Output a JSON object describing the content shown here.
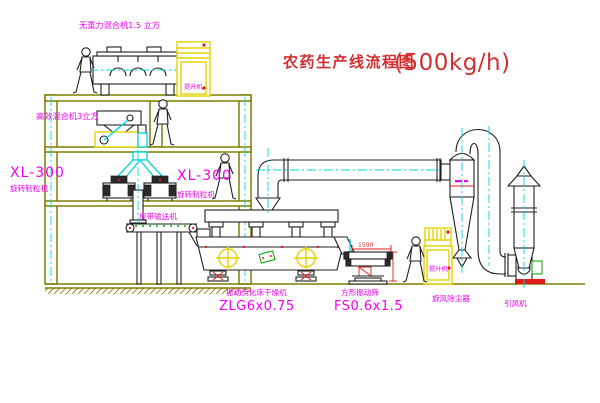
{
  "title": {
    "text": "农药生产线流程图",
    "capacity": "(500kg/h)"
  },
  "colors": {
    "label_magenta": "#f000f0",
    "title_red": "#d23030",
    "structure_olive": "#7f7f00",
    "machine_black": "#1f1f1f",
    "centerline_cyan": "#00d4da",
    "equipment_yellow": "#e3d400",
    "accent_red": "#e01818",
    "accent_green": "#00b400",
    "background": "#ffffff"
  },
  "labels": {
    "gravity_free_mixer": "无重力混合机1.5 立方",
    "high_efficiency_mixer": "高效混合机3立方",
    "granulator_wall": {
      "model": "XL-300",
      "name": "旋转制粒机"
    },
    "granulator": {
      "model": "XL-300",
      "name": "旋转制粒机"
    },
    "belt_conveyor": "皮带输送机",
    "dryer": {
      "name": "振动流化床干燥机",
      "model": "ZLG6x0.75"
    },
    "sieve": {
      "name": "方形振动筛",
      "model": "FS0.6x1.5"
    },
    "cyclone": "旋风除尘器",
    "fan": "引风机",
    "elevator_top": "提升机",
    "elevator_right": "提升机",
    "dim_width": "1500"
  }
}
